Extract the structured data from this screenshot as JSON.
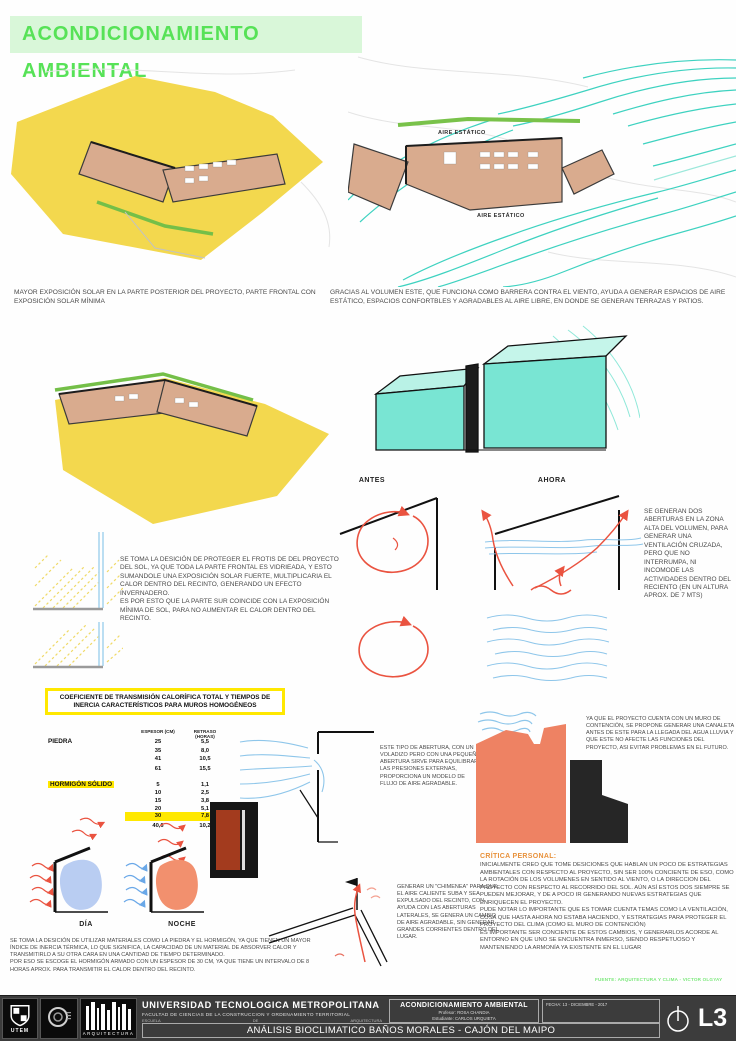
{
  "title": "ACONDICIONAMIENTO AMBIENTAL",
  "solar": {
    "caption": "MAYOR EXPOSICIÓN SOLAR EN LA PARTE POSTERIOR DEL PROYECTO, PARTE FRONTAL CON EXPOSICIÓN SOLAR MÍNIMA"
  },
  "viento": {
    "caption": "GRACIAS AL VOLUMEN ESTE, QUE FUNCIONA COMO BARRERA CONTRA EL VIENTO, AYUDA A GENERAR ESPACIOS DE AIRE ESTÁTICO, ESPACIOS CONFORTBLES Y AGRADABLES AL AIRE LIBRE, EN DONDE SE GENERAN TERRAZAS Y PATIOS.",
    "label_aire_1": "AIRE ESTÁTICO",
    "label_aire_2": "AIRE ESTÁTICO"
  },
  "vidrio": {
    "texto": "SE TOMA LA DESICIÓN DE PROTEGER EL FROTIS DE DEL PROYECTO DEL SOL, YA QUE TODA LA PARTE FRONTAL ES VIDRIEADA, Y ESTO SUMANDOLE UNA EXPOSICIÓN SOLAR FUERTE, MULTIPLICARIA EL CALOR DENTRO DEL RECINTO, GENERANDO UN EFECTO INVERNADERO.\nES POR ESTO QUE LA PARTE SUR COINCIDE CON LA EXPOSICIÓN MÍNIMA DE SOL, PARA NO AUMENTAR EL CALOR DENTRO DEL RECINTO."
  },
  "ventilacion": {
    "antes": "ANTES",
    "ahora": "AHORA",
    "nota": "SE GENERAN DOS ABERTURAS EN LA ZONA ALTA DEL VOLUMEN, PARA GENERAR UNA VENTILACIÓN CRUZADA, PERO QUE NO INTERRUMPA, NI INCOMODE LAS ACTIVIDADES DENTRO DEL RECIENTO (EN UN ALTURA APROX. DE 7 MTS)"
  },
  "tabla": {
    "titulo": "COEFICIENTE DE TRANSMISIÓN CALORÍFICA TOTAL Y TIEMPOS DE INERCIA CARACTERÍSTICOS PARA MUROS HOMOGÉNEOS",
    "col1": "ESPESOR (CM)",
    "col2": "RETRASO (HORAS)",
    "piedra": {
      "nombre": "PIEDRA",
      "filas": [
        [
          "25",
          "5,5"
        ],
        [
          "35",
          "8,0"
        ],
        [
          "41",
          "10,5"
        ],
        [
          "61",
          "15,5"
        ]
      ]
    },
    "hormigon": {
      "nombre": "HORMIGÓN SÓLIDO",
      "filas": [
        [
          "5",
          "1,1"
        ],
        [
          "10",
          "2,5"
        ],
        [
          "15",
          "3,8"
        ],
        [
          "20",
          "5,1"
        ],
        [
          "30",
          "7,8"
        ],
        [
          "40,6",
          "10,2"
        ]
      ]
    }
  },
  "abertura": {
    "nota": "ESTE TIPO DE ABERTURA, CON UN VOLADIZO PERO CON UNA PEQUEÑA ABERTURA SIRVE PARA EQUILIBRAR LAS PRESIONES EXTERNAS, PROPORCIONA UN MODELO DE FLUJO DE AIRE AGRADABLE."
  },
  "muro": {
    "nota": "YA QUE EL PROYECTO CUENTA CON UN MURO DE CONTENCIÓN, SE PROPONE GENERAR UNA CANALETA ANTES DE ESTE PARA LA LLEGADA DEL AGUA LLUVIA Y QUE ESTE NO AFECTE LAS FUNCIONES DEL PROYECTO, ASI EVITAR PROBLEMAS EN EL FUTURO."
  },
  "inercia": {
    "dia": "DÍA",
    "noche": "NOCHE",
    "texto": "SE TOMA LA DESICIÓN DE UTILIZAR MATERIALES COMO LA PIEDRA Y EL HORMIGÓN, YA QUE TIENEN UN MAYOR ÍNDICE DE INERCIA TÉRMICA, LO QUE SIGNIFICA, LA CAPACIDAD DE UN MATERIAL DE ABSORVER CALOR Y TRANSMITIRLO A SU OTRA CARA EN UNA CANTIDAD DE TIEMPO DETERMINADO.\nPOR ESO SE ESCOGE EL HORMIGÓN ARMADO CON UN ESPESOR DE 30 CM, YA QUE TIENE UN INTERVALO DE 8 HORAS APROX. PARA TRANSMITIR EL CALOR DENTRO DEL RECINTO."
  },
  "chimenea": {
    "nota": "GENERAR UN \"CHIMENEA\" PARA QUE EL AIRE CALIENTE SUBA Y SEA EXPULSADO DEL RECINTO, CON AYUDA CON LAS ABERTURAS LATERALES, SE GENERA UN CAMBIO DE AIRE AGRADABLE, SIN GENERAR GRANDES CORRIENTES DENTRO DEL LUGAR."
  },
  "critica": {
    "titulo": "CRÍTICA PERSONAL:",
    "texto": "INICIALMENTE CREO QUE TOME DESICIONES QUE HABLAN UN POCO DE ESTRATEGIAS AMBIENTALES CON RESPECTO AL PROYECTO, SIN SER 100% CONCIENTE DE ESO, COMO LA ROTACIÓN DE LOS VOLUMENES EN SENTIDO AL VIENTO, O LA DIRECCION DEL PROYECTO CON RESPECTO AL RECORRIDO DEL SOL. AÚN ASÍ ESTOS DOS SIEMPRE SE PUEDEN MEJORAR, Y DE A POCO IR GENERANDO NUEVAS ESTRATEGIAS QUE ENRIQUECEN EL PROYECTO.\nPUDE NOTAR LO IMPORTANTE QUE ES TOMAR CUENTA TEMAS COMO LA VENTILACIÓN, COSA QUE HASTA AHORA NO ESTABA HACIENDO, Y ESTRATEGIAS PARA PROTEGER EL PROYECTO DEL CLIMA (COMO EL MURO DE CONTENCIÓN)\nES IMPORTANTE SER CONCIENTE DE ESTOS CAMBIOS, Y GENERARLOS ACORDE AL ENTORNO EN QUE UNO SE ENCUENTRA INMERSO, SIENDO RESPETUOSO Y MANTENIENDO LA ARMONÍA YA EXISTENTE EN EL LUGAR"
  },
  "fuente": "FUENTE: ARQUITECTURA Y CLIMA - VICTOR OLGYAY",
  "footer": {
    "universidad": "UNIVERSIDAD TECNOLOGICA METROPOLITANA",
    "facultad": "FACULTAD DE CIENCIAS DE LA CONSTRUCCION Y ORDENAMIENTO TERRITORIAL",
    "escuela": "ESCUELA",
    "de": "DE",
    "arquitectura": "ARQUITECTURA",
    "proyecto": "ACONDICIONAMIENTO AMBIENTAL",
    "profesor": "Profesor: ROSA CHANDIA",
    "estudiante": "Estudiante: CARLOS URQUIETA",
    "fecha": "FECHA: 13 - DICIEMBRE - 2017",
    "subtitulo": "ANÁLISIS BIOCLIMATICO BAÑOS MORALES - CAJÓN DEL MAIPO",
    "lamina": "L3",
    "utem": "UTEM",
    "logo_arquitectura": "ARQUITECTURA"
  },
  "colors": {
    "accent_green": "#57e257",
    "banner_bg": "#d9f7d9",
    "sun_yellow": "#f3d84e",
    "wind_cyan": "#3ed2c0",
    "arrow_red": "#ea5340",
    "water_blue": "#8ec6ea",
    "warm_salmon": "#ee8263",
    "cool_blue": "#b9cdf2",
    "highlight_yellow": "#ffe800",
    "critique_orange": "#e8923c",
    "plan_tan": "#d9ab8e"
  }
}
